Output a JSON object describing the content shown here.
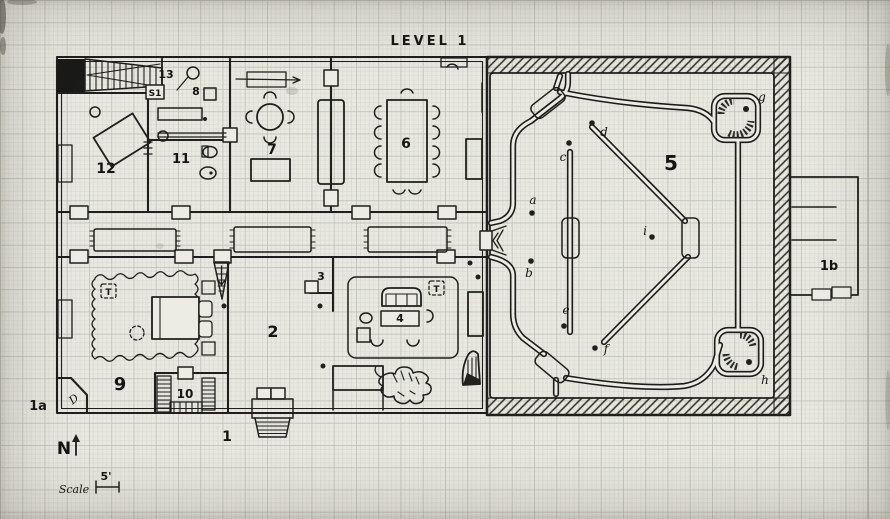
{
  "title": "LEVEL 1",
  "compass": {
    "label": "N"
  },
  "scale_bar": {
    "label": "Scale",
    "value": "5'"
  },
  "rooms": [
    {
      "id": "1",
      "label": "1"
    },
    {
      "id": "1a",
      "label": "1a"
    },
    {
      "id": "1b",
      "label": "1b"
    },
    {
      "id": "2",
      "label": "2"
    },
    {
      "id": "3",
      "label": "3"
    },
    {
      "id": "4",
      "label": "4"
    },
    {
      "id": "5",
      "label": "5"
    },
    {
      "id": "6",
      "label": "6"
    },
    {
      "id": "7",
      "label": "7"
    },
    {
      "id": "8",
      "label": "8"
    },
    {
      "id": "9",
      "label": "9"
    },
    {
      "id": "10",
      "label": "10"
    },
    {
      "id": "11",
      "label": "11"
    },
    {
      "id": "12",
      "label": "12"
    },
    {
      "id": "13",
      "label": "13"
    },
    {
      "id": "S1",
      "label": "S1"
    }
  ],
  "points": [
    {
      "id": "a",
      "label": "a"
    },
    {
      "id": "b",
      "label": "b"
    },
    {
      "id": "c",
      "label": "c"
    },
    {
      "id": "d",
      "label": "d"
    },
    {
      "id": "e",
      "label": "e"
    },
    {
      "id": "f",
      "label": "f"
    },
    {
      "id": "g",
      "label": "g"
    },
    {
      "id": "h",
      "label": "h"
    },
    {
      "id": "i",
      "label": "i"
    }
  ],
  "markers": {
    "treasure": "T",
    "secret_door": "D"
  },
  "colors": {
    "ink": "#1f1f1f",
    "paper": "#e9e8e1"
  }
}
